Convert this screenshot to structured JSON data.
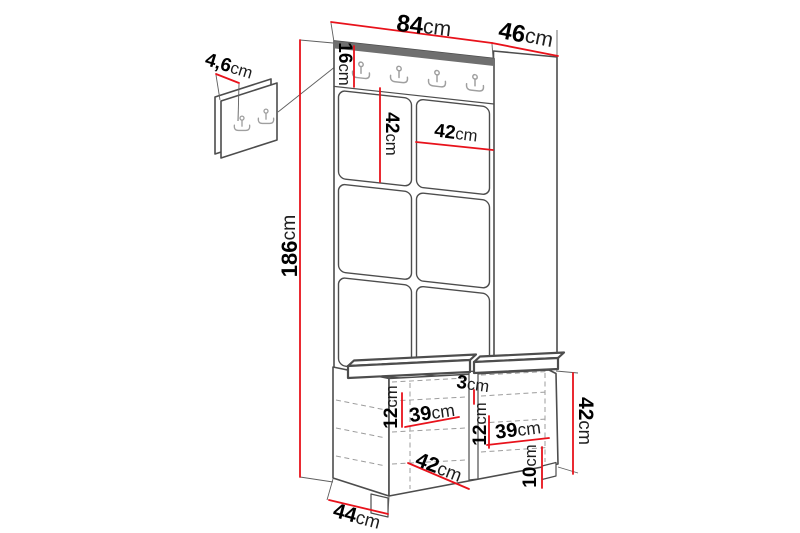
{
  "diagram": {
    "kind": "furniture-dimension-diagram",
    "subject": "hallway set: upholstered panel wardrobe with hook rail and storage bench, plus small wall hook panel",
    "colors": {
      "dimension_line": "#e8121b",
      "outline": "#4d4d4d",
      "hidden_line": "#9c9c9c",
      "top_strip": "#6f6f6f",
      "background": "#ffffff"
    },
    "icons": {
      "coat_hook": "double-coat-hook"
    },
    "panel": {
      "tile_rows": 3,
      "tile_columns": 2,
      "rail_hooks": 4
    },
    "wall_panel": {
      "hooks": 2
    },
    "dimensions": {
      "top_width": {
        "value": "84",
        "unit": "cm"
      },
      "top_depth": {
        "value": "46",
        "unit": "cm"
      },
      "small_panel_thickness": {
        "value": "4,6",
        "unit": "cm"
      },
      "total_height": {
        "value": "186",
        "unit": "cm"
      },
      "hook_rail_height": {
        "value": "16",
        "unit": "cm"
      },
      "panel_tile_height": {
        "value": "42",
        "unit": "cm"
      },
      "panel_tile_width": {
        "value": "42",
        "unit": "cm"
      },
      "seat_cushion_thickness": {
        "value": "3",
        "unit": "cm"
      },
      "left_opening_height": {
        "value": "12",
        "unit": "cm"
      },
      "left_opening_width": {
        "value": "39",
        "unit": "cm"
      },
      "middle_opening_height": {
        "value": "12",
        "unit": "cm"
      },
      "right_opening_width": {
        "value": "39",
        "unit": "cm"
      },
      "bench_opening_width": {
        "value": "42",
        "unit": "cm"
      },
      "plinth_height": {
        "value": "10",
        "unit": "cm"
      },
      "bench_height": {
        "value": "42",
        "unit": "cm"
      },
      "bench_depth": {
        "value": "44",
        "unit": "cm"
      }
    }
  }
}
